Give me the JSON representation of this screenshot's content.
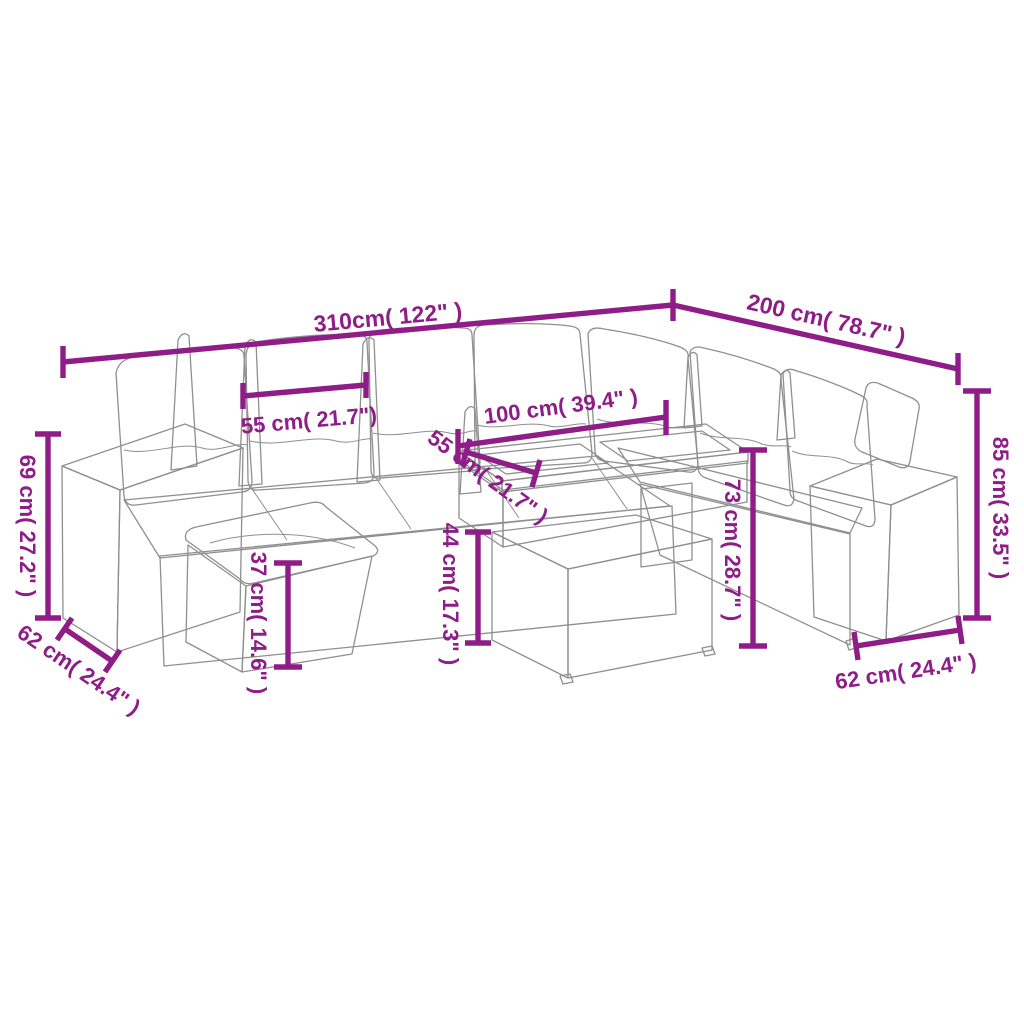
{
  "diagram": {
    "type": "product-dimension-diagram",
    "subject": "garden rattan lounge corner sofa set with ottoman and table",
    "background": "white"
  },
  "colors": {
    "dimension": "#8e1d87",
    "line_art": "#8f8f8f",
    "background": "#ffffff"
  },
  "dimensions": {
    "total_width": {
      "label": "310cm( 122\" )",
      "measures": "overall width left wing"
    },
    "total_depth": {
      "label": "200 cm( 78.7\" )",
      "measures": "overall depth right wing"
    },
    "back_cushion_width": {
      "label": "55 cm( 21.7\")",
      "measures": "back cushion width"
    },
    "table_length": {
      "label": "100 cm( 39.4\" )",
      "measures": "table top length"
    },
    "table_depth": {
      "label": "55 cm( 21.7\" )",
      "measures": "table top depth"
    },
    "arm_height_left": {
      "label": "69 cm( 27.2\" )",
      "measures": "armrest height"
    },
    "arm_depth_left": {
      "label": "62 cm( 24.4\" )",
      "measures": "armrest base depth left"
    },
    "ottoman_height": {
      "label": "37 cm( 14.6\" )",
      "measures": "ottoman height"
    },
    "table_lower_height": {
      "label": "44 cm( 17.3\" )",
      "measures": "table lower box height"
    },
    "table_height": {
      "label": "73 cm( 28.7\" )",
      "measures": "table overall height"
    },
    "back_height": {
      "label": "85 cm( 33.5\" )",
      "measures": "sofa back height"
    },
    "arm_depth_right": {
      "label": "62 cm( 24.4\" )",
      "measures": "armrest base depth right"
    }
  }
}
